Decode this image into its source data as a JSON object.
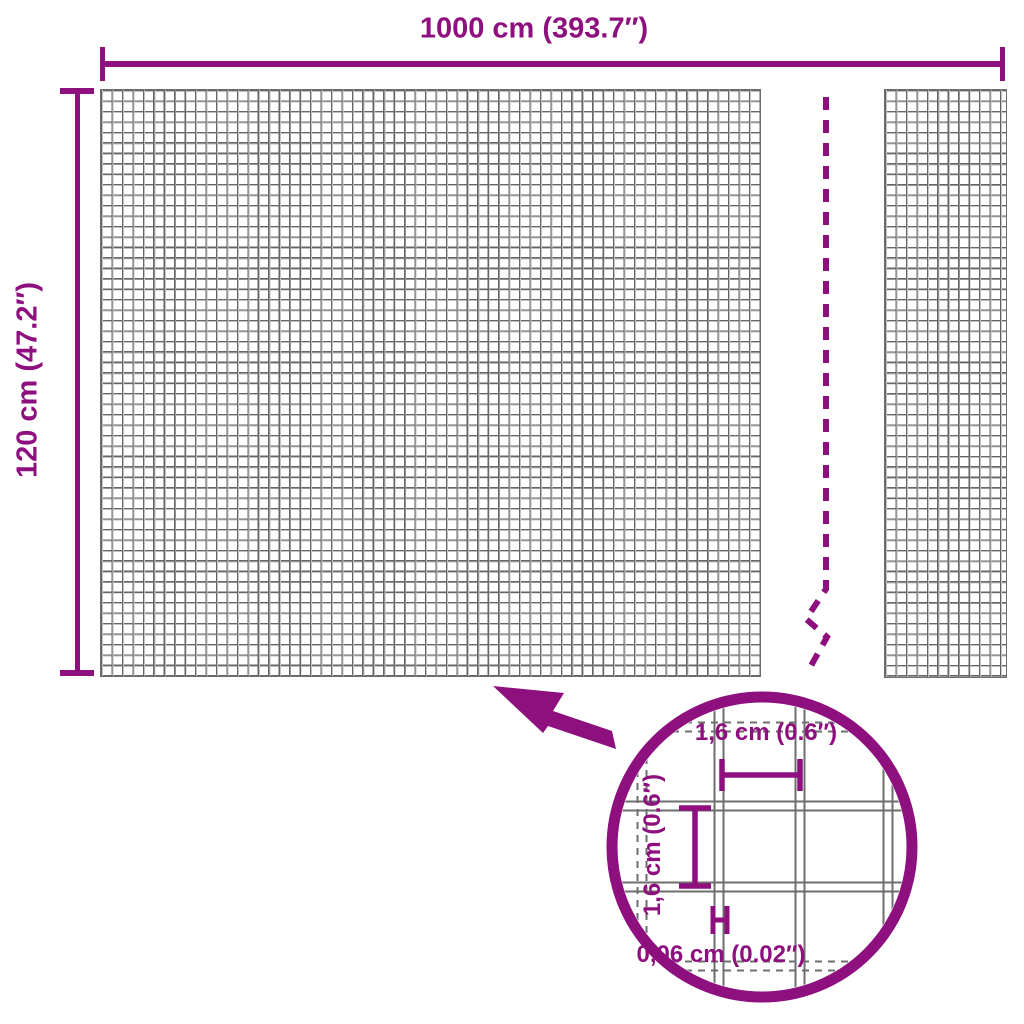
{
  "colors": {
    "accent_purple": "#8E0F7E",
    "mesh_gray": "#6E6E6E",
    "background": "#FFFFFF"
  },
  "product_diagram": {
    "width_label": "1000 cm (393.7″)",
    "height_label": "120 cm (47.2″)"
  },
  "detail_magnifier": {
    "mesh_opening_width_label": "1,6 cm (0.6″)",
    "mesh_opening_height_label": "1,6 cm (0.6″)",
    "wire_thickness_label": "0,06 cm (0.02″)"
  }
}
